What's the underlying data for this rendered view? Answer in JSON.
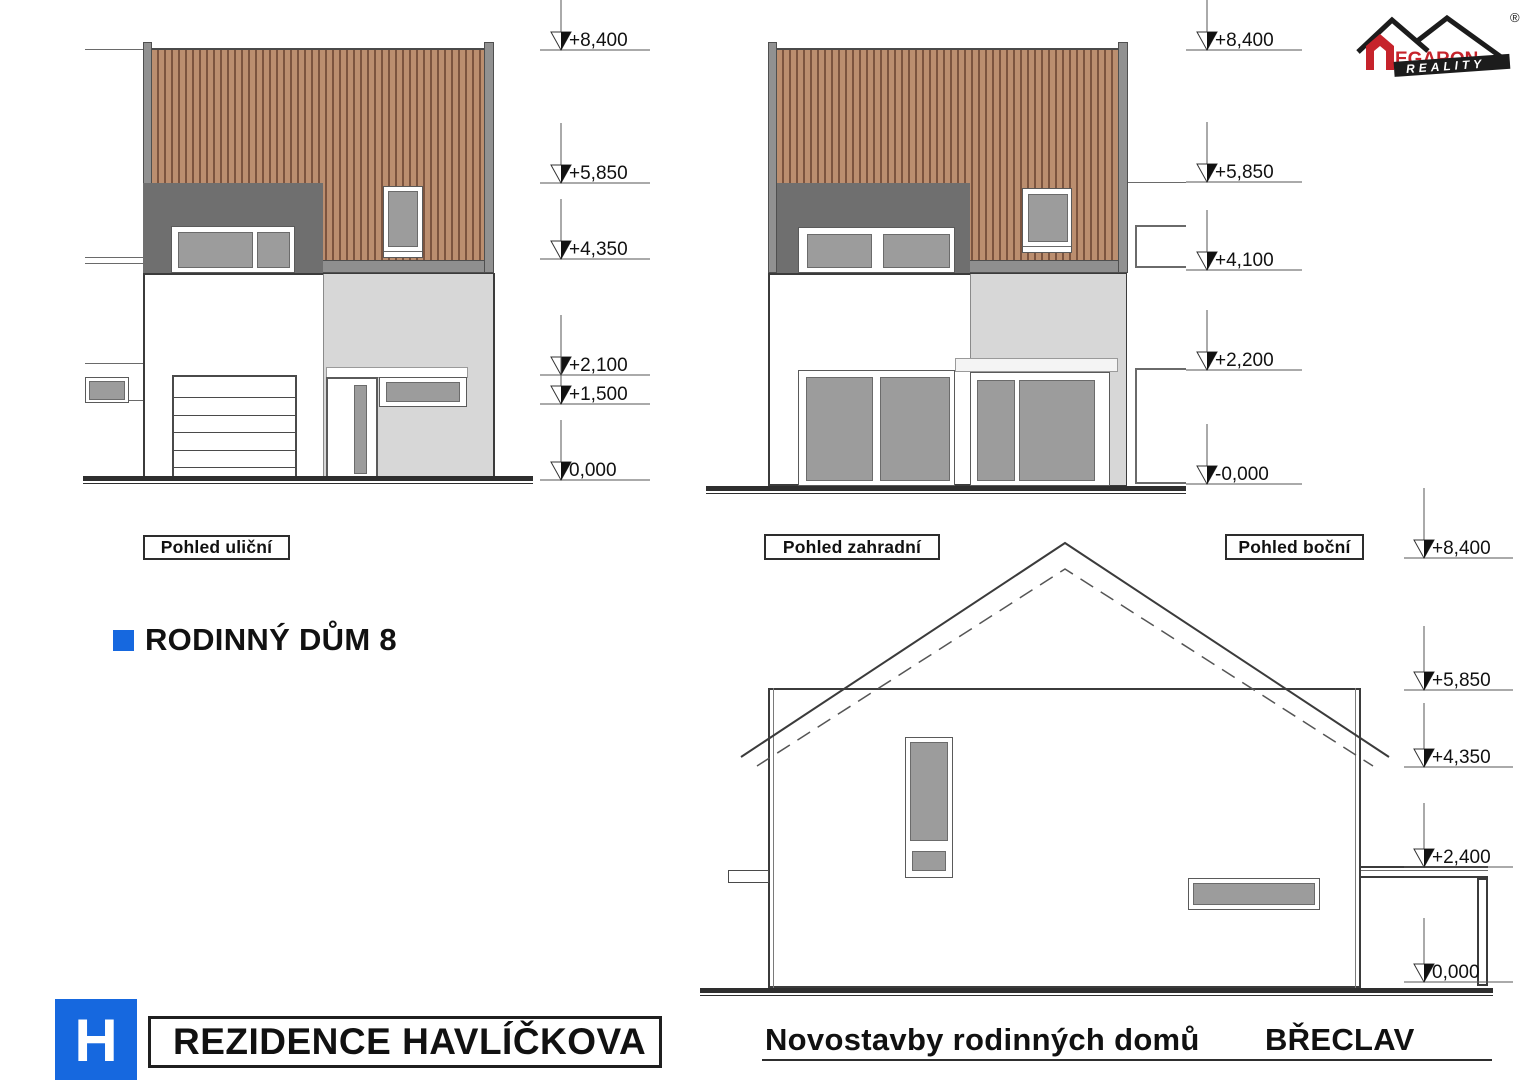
{
  "brand": {
    "name": "MEGARON",
    "name_tail": "EGARON",
    "tagline": "REALITY",
    "registered": "®"
  },
  "view_labels": {
    "street": "Pohled uliční",
    "garden": "Pohled zahradní",
    "side": "Pohled boční"
  },
  "title": {
    "text": "RODINNÝ DŮM 8"
  },
  "markers": {
    "street": [
      "+8,400",
      "+5,850",
      "+4,350",
      "+2,100",
      "+1,500",
      "0,000"
    ],
    "garden": [
      "+8,400",
      "+5,850",
      "+4,100",
      "+2,200",
      "-0,000"
    ],
    "side": [
      "+8,400",
      "+5,850",
      "+4,350",
      "+2,400",
      "0,000"
    ]
  },
  "footer": {
    "logo_letter": "H",
    "project": "REZIDENCE HAVLÍČKOVA",
    "line": "Novostavby rodinných domů",
    "city": "BŘECLAV"
  },
  "colors": {
    "accent_blue": "#1668df",
    "brand_red": "#c6232b",
    "wood": "#bb8e6f",
    "wood_stripe": "#7c543f",
    "band_dark": "#6f6f6f",
    "wall_light": "#d7d7d7",
    "glass": "#9c9c9c"
  }
}
